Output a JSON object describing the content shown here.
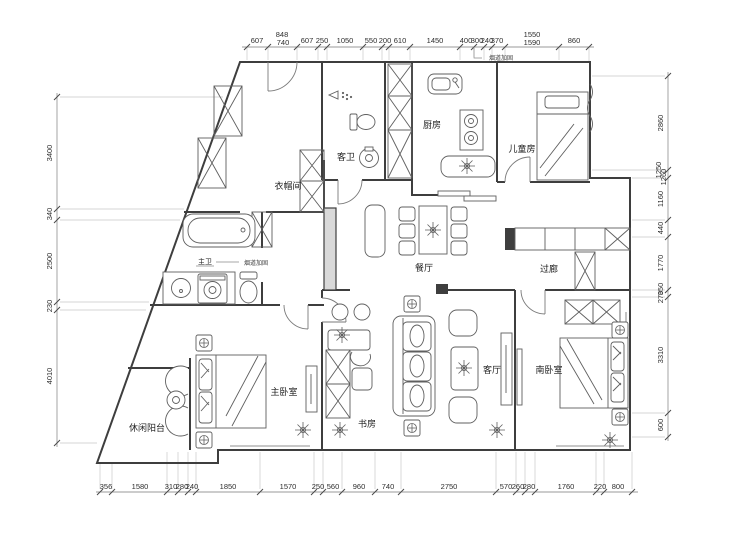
{
  "drawing_type": "apartment-floor-plan",
  "colors": {
    "wall": "#3e3e3e",
    "furniture": "#5f5f5f",
    "dimension_line": "#9a9a9a",
    "text": "#2e2e2e"
  },
  "rooms": {
    "kitchen": "厨房",
    "children_room": "儿童房",
    "guest_bath": "客卫",
    "cloakroom": "衣帽间",
    "dining": "餐厅",
    "corridor": "过廊",
    "master_bath": "主卫",
    "master_bedroom": "主卧室",
    "study": "书房",
    "living_room": "客厅",
    "south_bedroom": "南卧室",
    "balcony": "休闲阳台"
  },
  "annotations": {
    "flue_note_top": "烟道加固",
    "flue_note_mid": "烟道加固"
  },
  "dims": {
    "top": [
      "607",
      "848",
      "740",
      "607",
      "250",
      "1050",
      "550",
      "200",
      "610",
      "1450",
      "400",
      "300",
      "240",
      "370",
      "1550",
      "1590",
      "860"
    ],
    "bottom": [
      "356",
      "1580",
      "310",
      "280",
      "240",
      "1850",
      "1570",
      "250",
      "560",
      "960",
      "740",
      "2750",
      "570",
      "260",
      "280",
      "1760",
      "220",
      "800"
    ],
    "left": [
      "3400",
      "340",
      "2500",
      "230",
      "4010"
    ],
    "right": [
      "2860",
      "1250",
      "1260",
      "1160",
      "440",
      "1770",
      "350",
      "270",
      "3310",
      "600"
    ]
  }
}
